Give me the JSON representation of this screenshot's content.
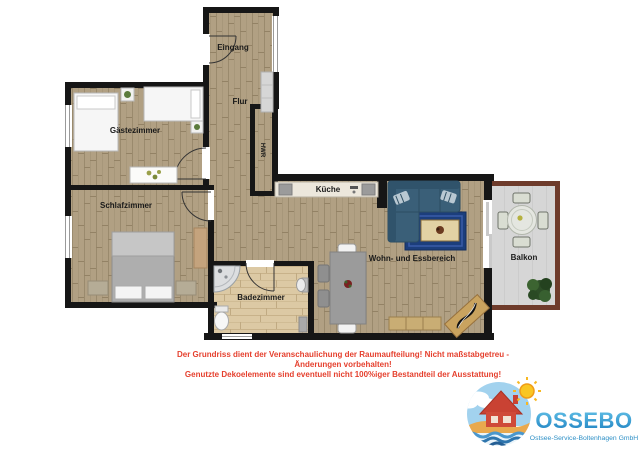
{
  "rooms": {
    "eingang": "Eingang",
    "flur": "Flur",
    "hwr": "HWR",
    "gaestezimmer": "Gästezimmer",
    "schlafzimmer": "Schlafzimmer",
    "kueche": "Küche",
    "badezimmer": "Badezimmer",
    "wohnbereich": "Wohn- und Essbereich",
    "balkon": "Balkon"
  },
  "disclaimer": {
    "line1": "Der Grundriss dient der Veranschaulichung der Raumaufteilung! Nicht maßstabgetreu -",
    "line2": "Änderungen vorbehalten!",
    "line3": "Genutzte Dekoelemente sind eventuell nicht 100%iger Bestandteil der Ausstattung!",
    "color": "#e5402e"
  },
  "logo": {
    "name": "OSSEBO",
    "subtitle": "Ostsee-Service-Boltenhagen GmbH",
    "text_color": "#2d8fc6"
  },
  "palette": {
    "wall": "#161616",
    "wood_floor": "#b1a083",
    "bath_floor": "#dcc9a4",
    "balcony_floor": "#d6d6d6",
    "railing": "#6e3b2b",
    "sofa": "#3a5f78",
    "rug": "#1c3e7c",
    "disclaimer_red": "#e5402e",
    "logo_blue": "#2d8fc6"
  }
}
